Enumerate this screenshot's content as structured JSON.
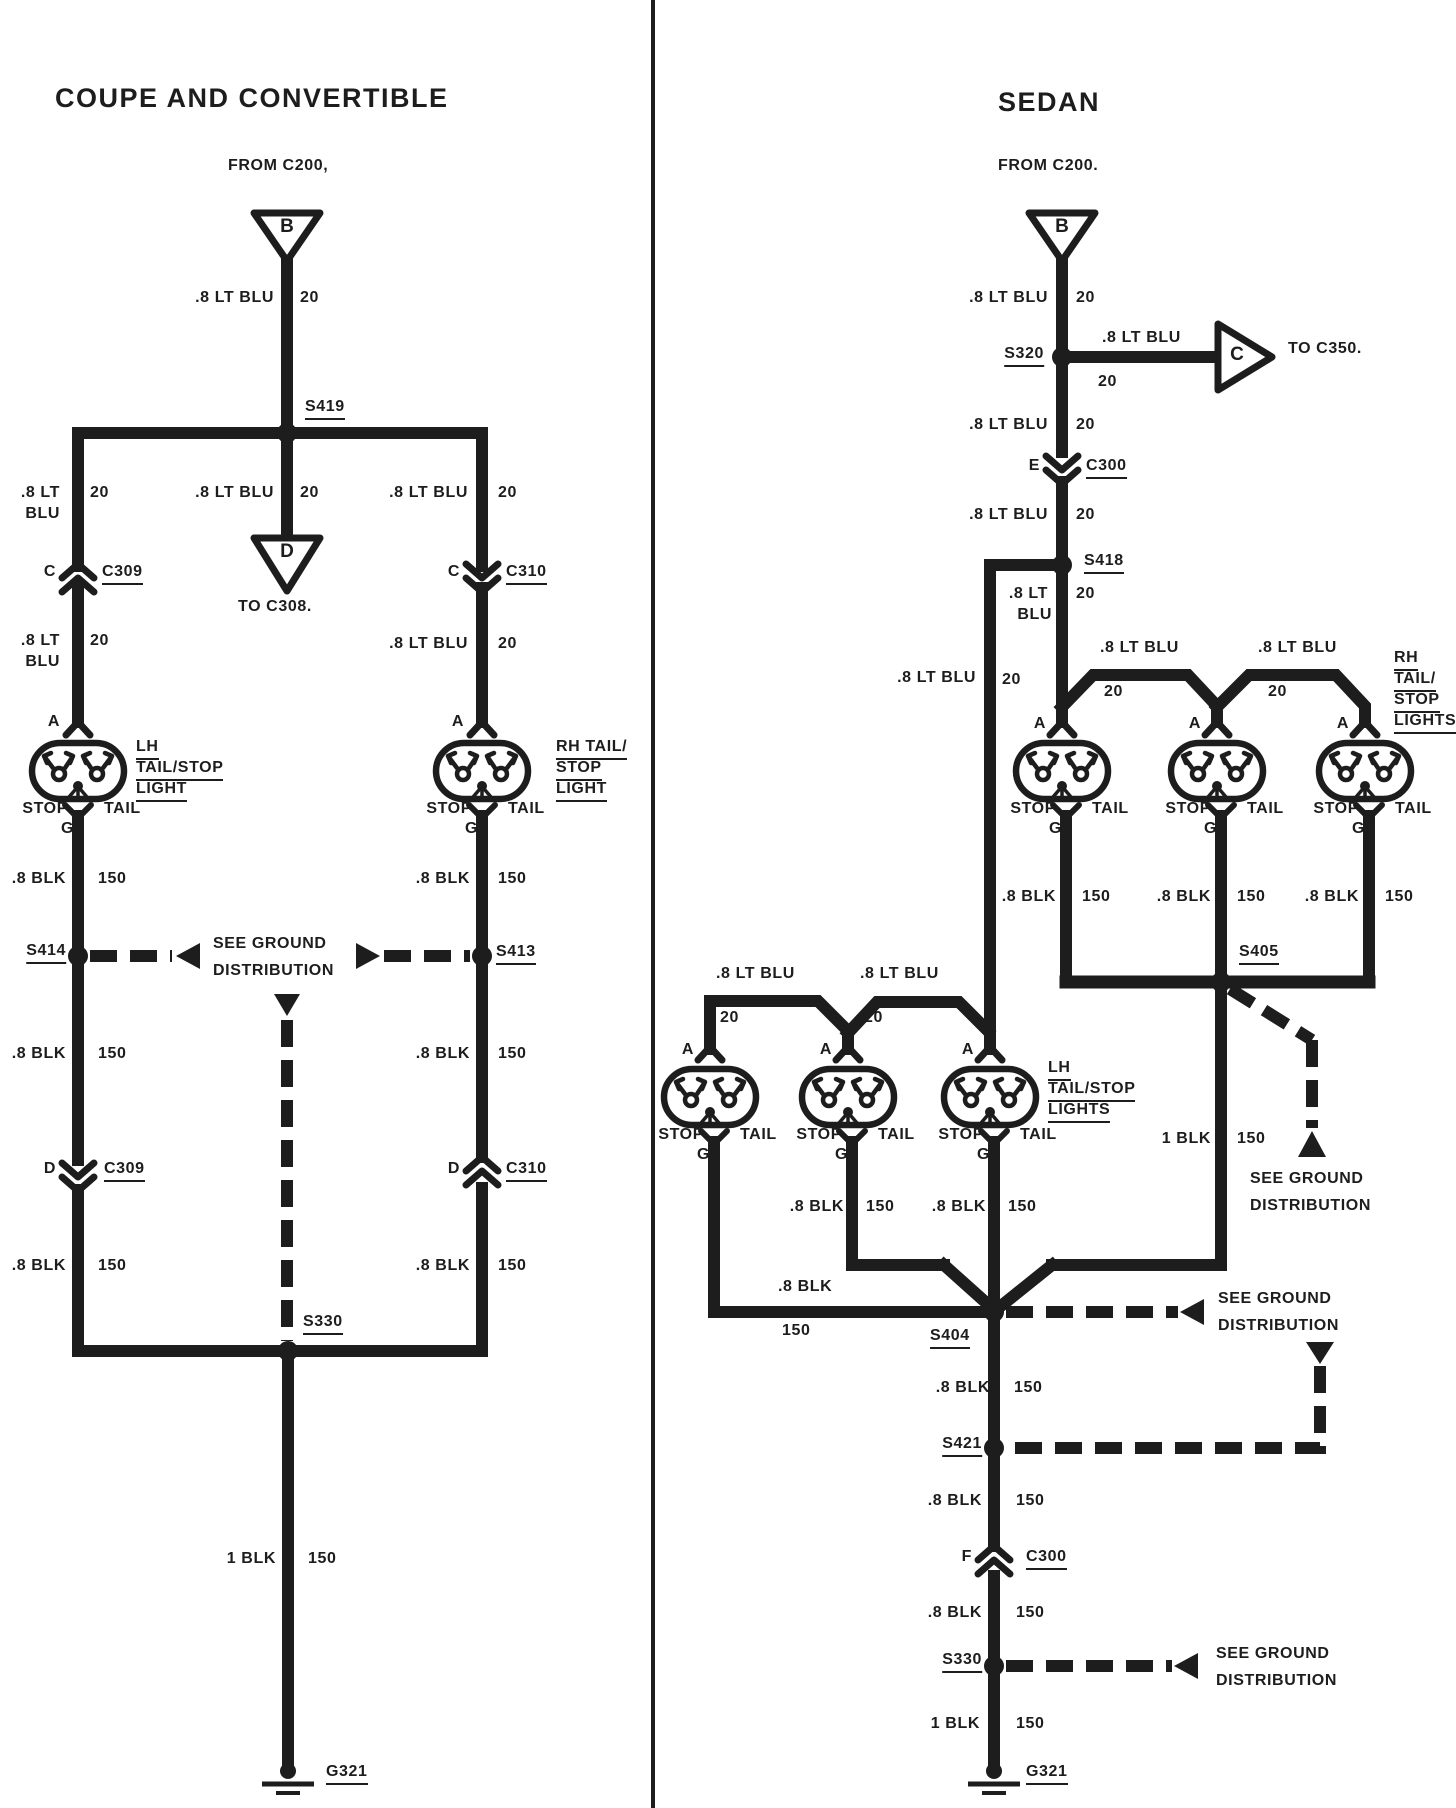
{
  "colors": {
    "ink": "#1d1d1d",
    "paper": "#ffffff"
  },
  "common": {
    "wire_ltblu": ".8 LT BLU",
    "wire_ltblu_l1": ".8 LT",
    "wire_ltblu_l2": "BLU",
    "wire_blk": ".8 BLK",
    "wire_1blk": "1 BLK",
    "ga20": "20",
    "ga150": "150",
    "stop": "STOP",
    "tail": "TAIL",
    "see_ground_1": "SEE GROUND",
    "see_ground_2": "DISTRIBUTION",
    "pins": {
      "a": "A",
      "b": "B",
      "c": "C",
      "d": "D",
      "e": "E",
      "f": "F",
      "g": "G"
    }
  },
  "coupe": {
    "title": "COUPE AND CONVERTIBLE",
    "from": "FROM C200,",
    "to_c308": "TO C308.",
    "s419": "S419",
    "s414": "S414",
    "s413": "S413",
    "s330": "S330",
    "c309": "C309",
    "c310": "C310",
    "g321": "G321",
    "lh_label": [
      "LH",
      "TAIL/STOP",
      "LIGHT"
    ],
    "rh_label": [
      "RH TAIL/",
      "STOP",
      "LIGHT"
    ]
  },
  "sedan": {
    "title": "SEDAN",
    "from": "FROM C200.",
    "to_c350": "TO C350.",
    "s320": "S320",
    "s418": "S418",
    "s405": "S405",
    "s404": "S404",
    "s421": "S421",
    "s330": "S330",
    "c300": "C300",
    "g321": "G321",
    "rh_label": [
      "RH",
      "TAIL/",
      "STOP",
      "LIGHTS"
    ],
    "lh_label": [
      "LH",
      "TAIL/STOP",
      "LIGHTS"
    ]
  }
}
